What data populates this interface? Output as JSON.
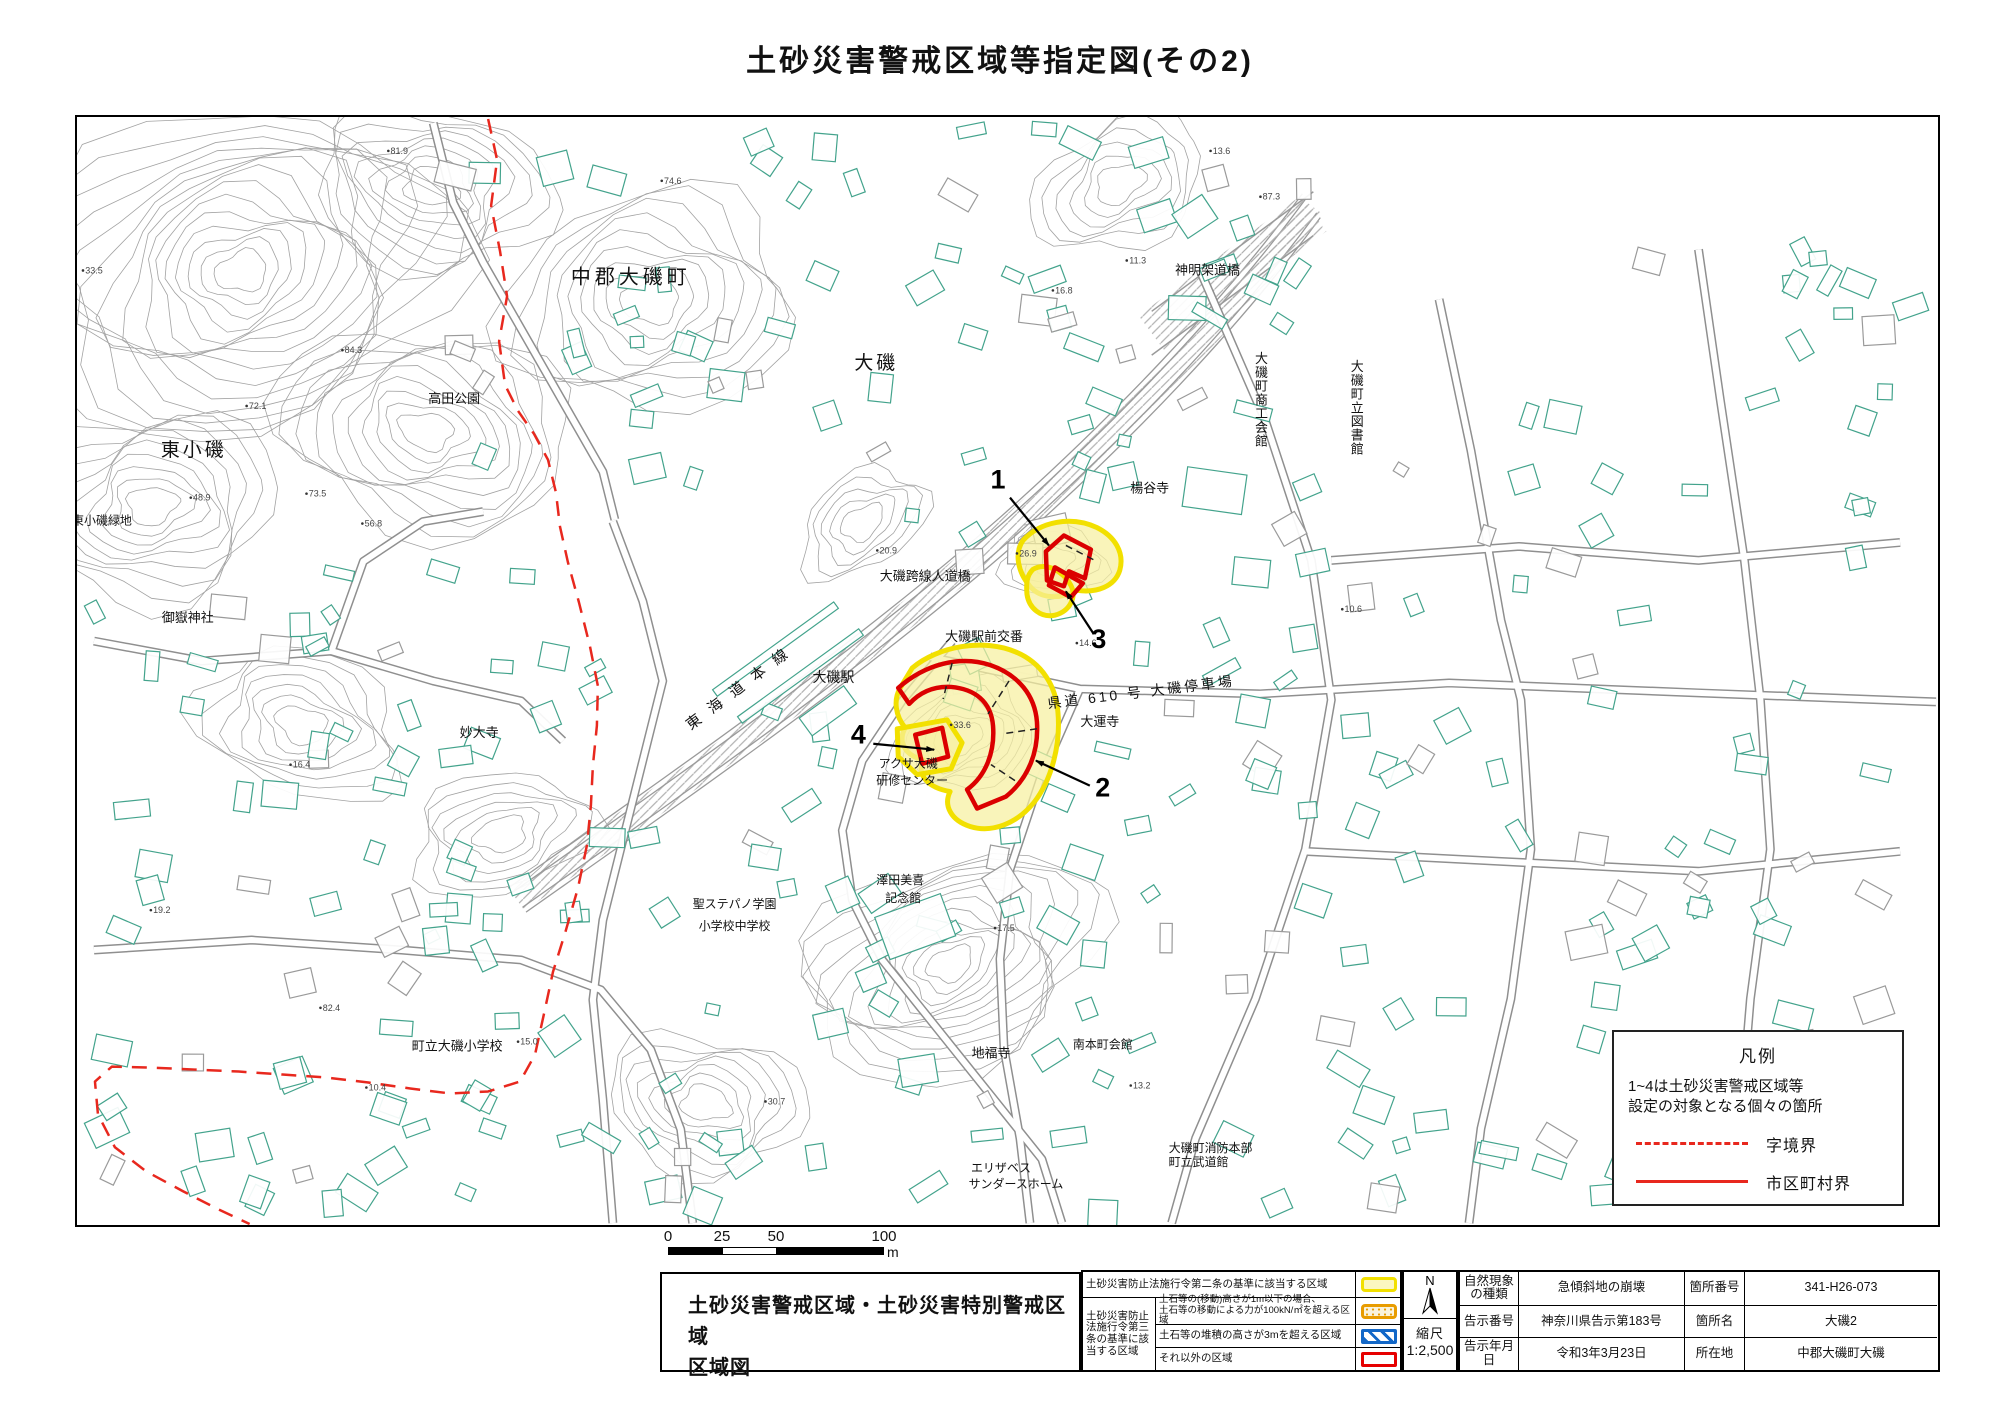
{
  "page": {
    "title": "土砂災害警戒区域等指定図(その2)"
  },
  "colors": {
    "zone_yellow_fill": "#f7f0a0",
    "zone_yellow_border": "#f2e000",
    "zone_red": "#db0000",
    "boundary_red": "#e8281e",
    "building_teal": "#43a38c",
    "contour_gray": "#a2a2a2",
    "legend_orange": "#e89c00",
    "legend_blue": "#1368c8",
    "legend_swatch_red": "#e60000"
  },
  "legend_box": {
    "title": "凡例",
    "line1": "1~4は土砂災害警戒区域等",
    "line2": "設定の対象となる個々の箇所",
    "dashed_label": "字境界",
    "solid_label": "市区町村界"
  },
  "scale_bar": {
    "ticks": [
      "0",
      "25",
      "50",
      "100"
    ],
    "unit": "m"
  },
  "footer": {
    "title_block": {
      "line1": "土砂災害警戒区域・土砂災害特別警戒区域",
      "line2": "区域図"
    },
    "legend_table": {
      "row1_label": "土砂災害防止法施行令第二条の基準に該当する区域",
      "group_label": "土砂災害防止法施行令第三条の基準に該当する区域",
      "row2_label": "土石等の(移動)高さが1m以下の場合、\n土石等の移動による力が100kN/㎡を超える区域",
      "row3_label": "土石等の堆積の高さが3mを超える区域",
      "row4_label": "それ以外の区域"
    },
    "compass": {
      "north": "N",
      "scale_label": "縮尺",
      "scale_value": "1:2,500"
    },
    "info_rows": [
      [
        "自然現象の種類",
        "急傾斜地の崩壊",
        "箇所番号",
        "341-H26-073"
      ],
      [
        "告示番号",
        "神奈川県告示第183号",
        "箇所名",
        "大磯2"
      ],
      [
        "告示年月日",
        "令和3年3月23日",
        "所在地",
        "中郡大磯町大磯"
      ]
    ]
  },
  "map": {
    "labels": [
      {
        "t": "中郡大磯町",
        "x": 630,
        "y": 282,
        "s": 20,
        "ls": 4
      },
      {
        "t": "大磯",
        "x": 876,
        "y": 368,
        "s": 19,
        "ls": 3
      },
      {
        "t": "東小磯",
        "x": 192,
        "y": 455,
        "s": 19,
        "ls": 3
      },
      {
        "t": "高田公園",
        "x": 453,
        "y": 402,
        "s": 13
      },
      {
        "t": "東小磯緑地",
        "x": 100,
        "y": 524,
        "s": 12
      },
      {
        "t": "御嶽神社",
        "x": 186,
        "y": 622,
        "s": 13
      },
      {
        "t": "妙大寺",
        "x": 478,
        "y": 737,
        "s": 13
      },
      {
        "t": "神明架道橋",
        "x": 1208,
        "y": 273,
        "s": 13
      },
      {
        "t": "大磯町商工会館",
        "x": 1262,
        "y": 362,
        "s": 13,
        "v": 1
      },
      {
        "t": "楊谷寺",
        "x": 1150,
        "y": 492,
        "s": 13
      },
      {
        "t": "大磯町立図書館",
        "x": 1358,
        "y": 370,
        "s": 13,
        "v": 1
      },
      {
        "t": "大磯跨線人道橋",
        "x": 925,
        "y": 580,
        "s": 13
      },
      {
        "t": "大磯駅前交番",
        "x": 984,
        "y": 641,
        "s": 13
      },
      {
        "t": "東海道本線",
        "x": 744,
        "y": 690,
        "s": 15,
        "r": -37,
        "ls": 12
      },
      {
        "t": "大磯駅",
        "x": 833,
        "y": 682,
        "s": 14
      },
      {
        "t": "県道 610 号 大磯停車場",
        "x": 1142,
        "y": 697,
        "s": 14,
        "r": -7,
        "ls": 3
      },
      {
        "t": "大運寺",
        "x": 1100,
        "y": 726,
        "s": 13
      },
      {
        "t": "アクサ大磯",
        "x": 908,
        "y": 768,
        "s": 12
      },
      {
        "t": "研修センター",
        "x": 912,
        "y": 785,
        "s": 12
      },
      {
        "t": "澤田美喜",
        "x": 900,
        "y": 885,
        "s": 12
      },
      {
        "t": "記念館",
        "x": 903,
        "y": 903,
        "s": 12
      },
      {
        "t": "聖ステパノ学園",
        "x": 734,
        "y": 909,
        "s": 12
      },
      {
        "t": "小学校中学校",
        "x": 734,
        "y": 931,
        "s": 12
      },
      {
        "t": "町立大磯小学校",
        "x": 456,
        "y": 1052,
        "s": 13
      },
      {
        "t": "地福寺",
        "x": 991,
        "y": 1059,
        "s": 13
      },
      {
        "t": "南本町会館",
        "x": 1103,
        "y": 1050,
        "s": 12
      },
      {
        "t": "エリザベス",
        "x": 1001,
        "y": 1174,
        "s": 12
      },
      {
        "t": "サンダースホーム",
        "x": 1016,
        "y": 1190,
        "s": 12
      },
      {
        "t": "大磯町消防本部",
        "x": 1211,
        "y": 1154,
        "s": 12
      },
      {
        "t": "町立武道館",
        "x": 1199,
        "y": 1168,
        "s": 12
      }
    ],
    "spot_heights": [
      [
        "84.3",
        352,
        352
      ],
      [
        "72.1",
        256,
        408
      ],
      [
        "73.5",
        316,
        496
      ],
      [
        "81.9",
        398,
        152
      ],
      [
        "74.6",
        672,
        182
      ],
      [
        "33.5",
        92,
        272
      ],
      [
        "48.9",
        200,
        500
      ],
      [
        "56.8",
        372,
        526
      ],
      [
        "82.4",
        330,
        1012
      ],
      [
        "87.3",
        1272,
        198
      ],
      [
        "16.4",
        300,
        768
      ],
      [
        "15.0",
        528,
        1046
      ],
      [
        "30.7",
        776,
        1106
      ],
      [
        "17.5",
        1006,
        932
      ],
      [
        "10.4",
        376,
        1092
      ],
      [
        "19.2",
        160,
        914
      ],
      [
        "13.2",
        1142,
        1090
      ],
      [
        "13.6",
        1222,
        152
      ],
      [
        "11.3",
        1138,
        262
      ],
      [
        "16.8",
        1064,
        292
      ],
      [
        "14.6",
        1088,
        646
      ],
      [
        "10.6",
        1354,
        612
      ],
      [
        "33.6",
        962,
        728
      ],
      [
        "26.9",
        1028,
        556
      ],
      [
        "20.9",
        888,
        553
      ]
    ],
    "numbers": [
      {
        "n": "1",
        "x": 998,
        "y": 488,
        "a": [
          1010,
          497,
          1049,
          545
        ]
      },
      {
        "n": "3",
        "x": 1099,
        "y": 648,
        "a": [
          1094,
          634,
          1066,
          591
        ]
      },
      {
        "n": "2",
        "x": 1103,
        "y": 797,
        "a": [
          1090,
          786,
          1036,
          761
        ]
      },
      {
        "n": "4",
        "x": 858,
        "y": 744,
        "a": [
          873,
          744,
          934,
          750
        ]
      }
    ],
    "zones": {
      "yellow": [
        "M 912,668 C 938,646 984,638 1016,652 C 1042,663 1056,686 1058,712 C 1061,744 1052,780 1034,803 C 1017,824 992,834 970,827 C 951,821 943,806 950,792 C 928,788 916,776 923,760 C 905,756 897,742 905,728 C 895,716 893,700 900,688 Z",
        "M 897,729 L 947,720 L 962,743 L 951,769 L 917,775 L 898,757 Z",
        "M 1023,540 C 1040,521 1071,515 1097,527 C 1115,536 1125,552 1120,570 C 1115,586 1097,593 1077,590 C 1059,600 1040,598 1030,586 C 1018,572 1014,553 1023,540 Z",
        "M 1033,569 C 1047,561 1063,571 1071,585 C 1077,597 1070,611 1055,615 C 1041,618 1029,608 1027,594 C 1026,582 1027,575 1033,569 Z"
      ],
      "red": [
        "M 898,688 C 925,664 960,655 990,665 C 1019,675 1035,696 1037,722 C 1039,753 1028,779 1006,797 L 977,809 L 967,790 C 986,776 995,752 993,726 C 991,701 974,689 951,687 C 933,686 919,693 909,704 Z",
        "M 1046,551 L 1064,535 L 1091,549 L 1085,578 L 1069,571 L 1064,586 L 1047,580 Z",
        "M 1055,567 L 1083,583 L 1071,597 L 1049,585 Z",
        "M 915,735 L 942,728 L 948,757 L 922,764 Z"
      ],
      "dashes": [
        [
          952,
          663,
          943,
          699
        ],
        [
          1009,
          681,
          988,
          714
        ],
        [
          1037,
          729,
          1003,
          734
        ],
        [
          1015,
          781,
          991,
          765
        ],
        [
          1066,
          545,
          1097,
          561
        ]
      ]
    },
    "boundary": "487,117 496,158 490,204 499,250 506,295 498,340 504,384 517,410 533,433 547,459 555,492 559,526 567,562 578,602 589,646 597,686 596,726 592,766 590,806 586,846 577,889 565,931 552,973 543,1015 534,1056 519,1083 487,1093 449,1095 409,1090 367,1084 325,1079 281,1076 237,1073 193,1071 149,1069 110,1068 93,1083 96,1116 113,1149 144,1173 181,1193 216,1211 248,1226",
    "railway": {
      "d": "M 516,901 C 690,778 860,660 1010,528 C 1120,430 1230,316 1312,204",
      "bridge": [
        1152,
        332,
        1314,
        212
      ]
    },
    "roads": [
      "930,657 1080,689 1260,694 1450,683 1700,693 1938,702",
      "1200,268 1266,420 1312,560 1332,700 1306,850 1256,1000 1196,1140 1172,1225",
      "1440,298 1472,450 1502,620 1522,700 1532,850 1512,1000 1482,1130 1470,1225",
      "1700,248 1722,400 1746,560 1762,700 1772,850 1752,1000 1742,1120",
      "1332,560 1520,546 1700,560 1902,542",
      "1306,852 1500,862 1700,872 1902,852",
      "92,641 200,661 330,651 432,681 520,701 562,741",
      "330,651 362,561 422,521 482,511",
      "92,951 250,941 400,951 520,961 600,991 650,1051 680,1131 692,1225",
      "612,521 642,601 662,681 642,761 622,841 602,921 592,1001 602,1101 612,1225",
      "432,121 452,201 482,261 522,331 562,401 602,471 614,519",
      "952,641 902,701 862,761 842,831 852,901 882,961 922,1011 962,1061 1002,1111 1042,1161 1062,1225",
      "1080,689 1040,780 1010,870 1000,960 1004,1050 1020,1140 1030,1225"
    ],
    "contours": [
      {
        "cx": 240,
        "cy": 270,
        "rx": 210,
        "ry": 160,
        "n": 15,
        "rot": -15,
        "seed": 1
      },
      {
        "cx": 430,
        "cy": 185,
        "rx": 120,
        "ry": 85,
        "n": 8,
        "rot": 10,
        "seed": 2
      },
      {
        "cx": 150,
        "cy": 505,
        "rx": 125,
        "ry": 95,
        "n": 9,
        "rot": -8,
        "seed": 3
      },
      {
        "cx": 425,
        "cy": 430,
        "rx": 150,
        "ry": 100,
        "n": 10,
        "rot": 12,
        "seed": 4
      },
      {
        "cx": 650,
        "cy": 300,
        "rx": 145,
        "ry": 110,
        "n": 9,
        "rot": -6,
        "seed": 5
      },
      {
        "cx": 300,
        "cy": 725,
        "rx": 105,
        "ry": 72,
        "n": 7,
        "rot": 20,
        "seed": 6
      },
      {
        "cx": 500,
        "cy": 835,
        "rx": 92,
        "ry": 60,
        "n": 6,
        "rot": -14,
        "seed": 7
      },
      {
        "cx": 950,
        "cy": 965,
        "rx": 155,
        "ry": 105,
        "n": 12,
        "rot": -25,
        "seed": 8
      },
      {
        "cx": 705,
        "cy": 1105,
        "rx": 100,
        "ry": 70,
        "n": 7,
        "rot": 8,
        "seed": 9
      },
      {
        "cx": 1120,
        "cy": 182,
        "rx": 92,
        "ry": 62,
        "n": 6,
        "rot": -30,
        "seed": 10
      },
      {
        "cx": 962,
        "cy": 738,
        "rx": 72,
        "ry": 52,
        "n": 6,
        "rot": -20,
        "seed": 11
      },
      {
        "cx": 862,
        "cy": 522,
        "rx": 70,
        "ry": 46,
        "n": 5,
        "rot": -35,
        "seed": 12
      },
      {
        "cx": 1052,
        "cy": 560,
        "rx": 52,
        "ry": 36,
        "n": 4,
        "rot": 0,
        "seed": 13
      }
    ],
    "building_regions": [
      {
        "x1": 1160,
        "y1": 235,
        "x2": 1915,
        "y2": 1200,
        "n": 115,
        "seed": 7
      },
      {
        "x1": 400,
        "y1": 130,
        "x2": 950,
        "y2": 515,
        "n": 38,
        "seed": 11
      },
      {
        "x1": 85,
        "y1": 545,
        "x2": 600,
        "y2": 1005,
        "n": 52,
        "seed": 21
      },
      {
        "x1": 605,
        "y1": 705,
        "x2": 1150,
        "y2": 1215,
        "n": 52,
        "seed": 31
      },
      {
        "x1": 950,
        "y1": 120,
        "x2": 1300,
        "y2": 430,
        "n": 26,
        "seed": 41
      },
      {
        "x1": 930,
        "y1": 430,
        "x2": 1150,
        "y2": 700,
        "n": 16,
        "seed": 51
      },
      {
        "x1": 85,
        "y1": 1010,
        "x2": 600,
        "y2": 1215,
        "n": 28,
        "seed": 61
      }
    ],
    "fixed_buildings": [
      {
        "x": 700,
        "y": 645,
        "w": 150,
        "h": 8,
        "r": -36
      },
      {
        "x": 725,
        "y": 672,
        "w": 150,
        "h": 8,
        "r": -36
      },
      {
        "x": 800,
        "y": 700,
        "w": 55,
        "h": 22,
        "r": -36
      },
      {
        "x": 1185,
        "y": 470,
        "w": 60,
        "h": 40,
        "r": 8
      },
      {
        "x": 880,
        "y": 905,
        "w": 70,
        "h": 45,
        "r": -20
      }
    ]
  }
}
